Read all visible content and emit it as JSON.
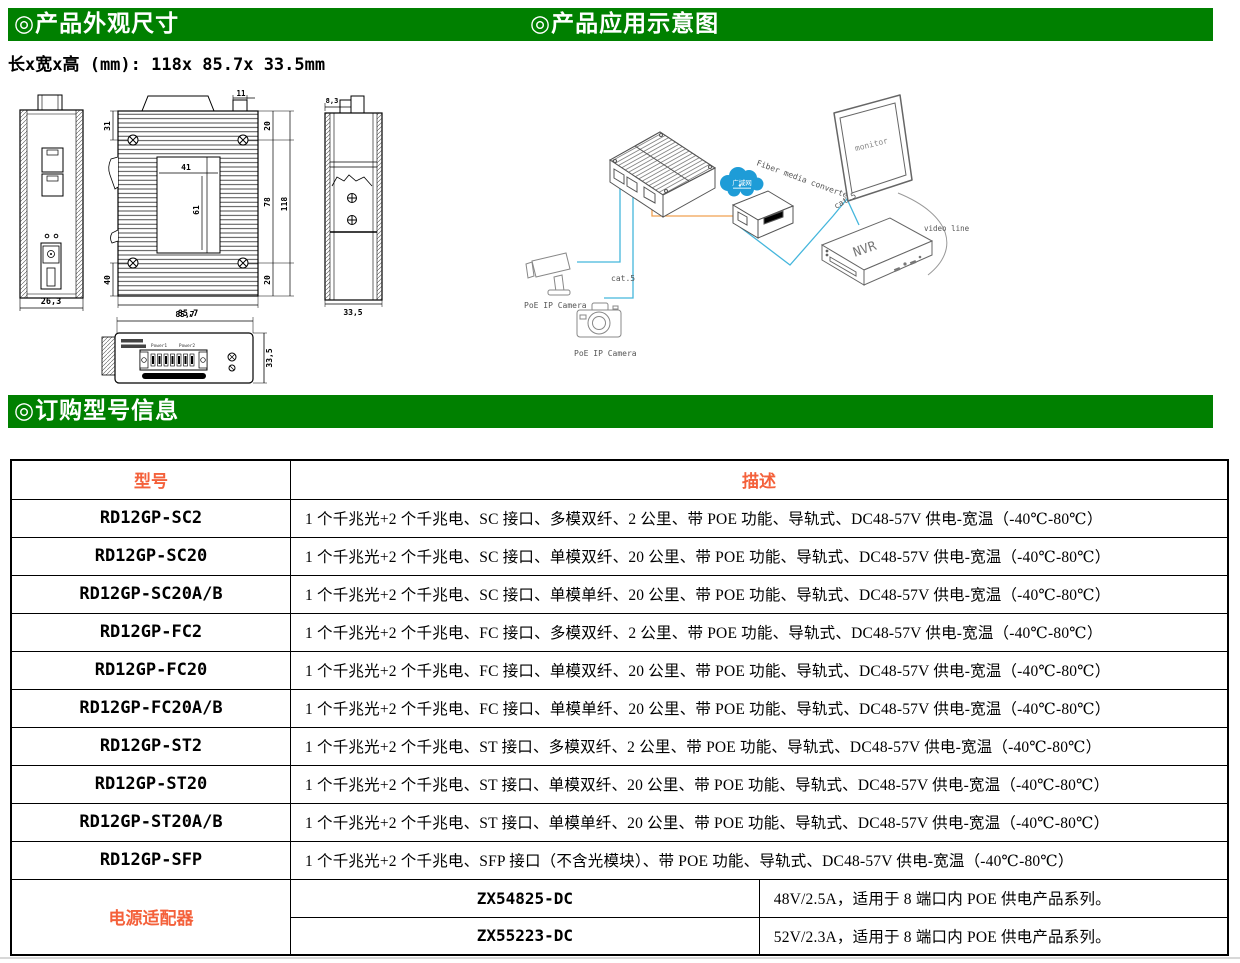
{
  "sections": {
    "appearance_title": "◎产品外观尺寸",
    "application_title": "◎产品应用示意图",
    "ordering_title": "◎订购型号信息"
  },
  "size_note": "长x宽x高 (mm): 118x 85.7x 33.5mm",
  "drawings": {
    "front": {
      "width": "26,3"
    },
    "back": {
      "top": "11",
      "left_upper": "31",
      "left_lower": "40",
      "plate_w": "41",
      "plate_h": "61",
      "right_upper": "20",
      "right_mid": "78",
      "right_lower": "20",
      "height": "118",
      "width": "85,7"
    },
    "side": {
      "top": "8,3",
      "width": "33,5"
    },
    "bottom": {
      "width": "85,7",
      "depth": "33,5",
      "power1": "Power1",
      "power2": "Power2"
    }
  },
  "diagram": {
    "cloud_label": "广域网",
    "converter_label": "Fiber media converter",
    "monitor_label": "monitor",
    "nvr_label": "NVR",
    "video_line_label": "video line",
    "cat5_label_a": "cat.5",
    "cat5_label_b": "cat.5",
    "camera_label_a": "PoE IP Camera",
    "camera_label_b": "PoE IP Camera"
  },
  "order_table": {
    "col_model": "型号",
    "col_desc": "描述",
    "rows": [
      {
        "model": "RD12GP-SC2",
        "desc": "1 个千兆光+2 个千兆电、SC 接口、多模双纤、2 公里、带 POE 功能、导轨式、DC48-57V 供电-宽温（-40℃-80℃）"
      },
      {
        "model": "RD12GP-SC20",
        "desc": "1 个千兆光+2 个千兆电、SC 接口、单模双纤、20 公里、带 POE 功能、导轨式、DC48-57V 供电-宽温（-40℃-80℃）"
      },
      {
        "model": "RD12GP-SC20A/B",
        "desc": "1 个千兆光+2 个千兆电、SC 接口、单模单纤、20 公里、带 POE 功能、导轨式、DC48-57V 供电-宽温（-40℃-80℃）"
      },
      {
        "model": "RD12GP-FC2",
        "desc": "1 个千兆光+2 个千兆电、FC 接口、多模双纤、2 公里、带 POE 功能、导轨式、DC48-57V 供电-宽温（-40℃-80℃）"
      },
      {
        "model": "RD12GP-FC20",
        "desc": "1 个千兆光+2 个千兆电、FC 接口、单模双纤、20 公里、带 POE 功能、导轨式、DC48-57V 供电-宽温（-40℃-80℃）"
      },
      {
        "model": "RD12GP-FC20A/B",
        "desc": "1 个千兆光+2 个千兆电、FC 接口、单模单纤、20 公里、带 POE 功能、导轨式、DC48-57V 供电-宽温（-40℃-80℃）"
      },
      {
        "model": "RD12GP-ST2",
        "desc": "1 个千兆光+2 个千兆电、ST 接口、多模双纤、2 公里、带 POE 功能、导轨式、DC48-57V 供电-宽温（-40℃-80℃）"
      },
      {
        "model": "RD12GP-ST20",
        "desc": "1 个千兆光+2 个千兆电、ST 接口、单模双纤、20 公里、带 POE 功能、导轨式、DC48-57V 供电-宽温（-40℃-80℃）"
      },
      {
        "model": "RD12GP-ST20A/B",
        "desc": "1 个千兆光+2 个千兆电、ST 接口、单模单纤、20 公里、带 POE 功能、导轨式、DC48-57V 供电-宽温（-40℃-80℃）"
      },
      {
        "model": "RD12GP-SFP",
        "desc": "1 个千兆光+2 个千兆电、SFP 接口（不含光模块）、带 POE 功能、导轨式、DC48-57V 供电-宽温（-40℃-80℃）"
      }
    ],
    "adapter_label": "电源适配器",
    "adapter_rows": [
      {
        "model": "ZX54825-DC",
        "desc": "48V/2.5A，适用于 8 端口内 POE 供电产品系列。"
      },
      {
        "model": "ZX55223-DC",
        "desc": "52V/2.3A，适用于 8 端口内 POE 供电产品系列。"
      }
    ]
  },
  "colors": {
    "header_green": "#008000",
    "accent_red": "#f4613b",
    "cable_blue": "#45b6dc",
    "cable_orange": "#f0a050",
    "cloud_blue": "#1e9cd7"
  }
}
